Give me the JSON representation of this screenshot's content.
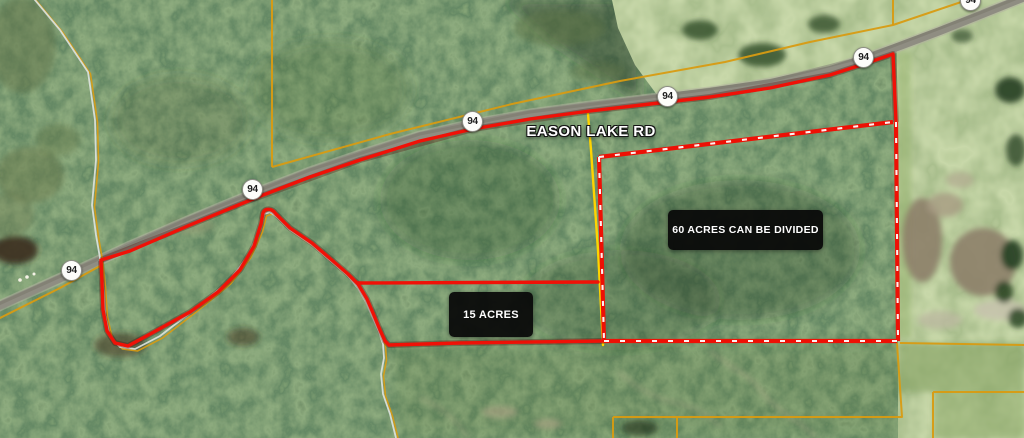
{
  "map": {
    "road_label": "EASON LAKE RD",
    "route_shield_label": "94",
    "parcels": {
      "large_label": "60 ACRES CAN BE DIVIDED",
      "small_label": "15 ACRES"
    },
    "colors": {
      "boundary_red": "#f01107",
      "divisible_boundary_dash_white": "#ffffff",
      "parcel_line_orange": "#d89b12",
      "survey_line_yellow": "#ffd400",
      "label_box_background": "#0a0a0a",
      "label_text": "#ffffff",
      "road_surface_gray": "#8f8d82",
      "creek_gray": "#dce2dc",
      "forest_green_dark": "#2f4a2b",
      "field_green_light": "#7e9c60",
      "pond_tan": "#9a8d76",
      "shield_background": "#fdfdfa",
      "shield_text": "#1e1e1e"
    }
  }
}
